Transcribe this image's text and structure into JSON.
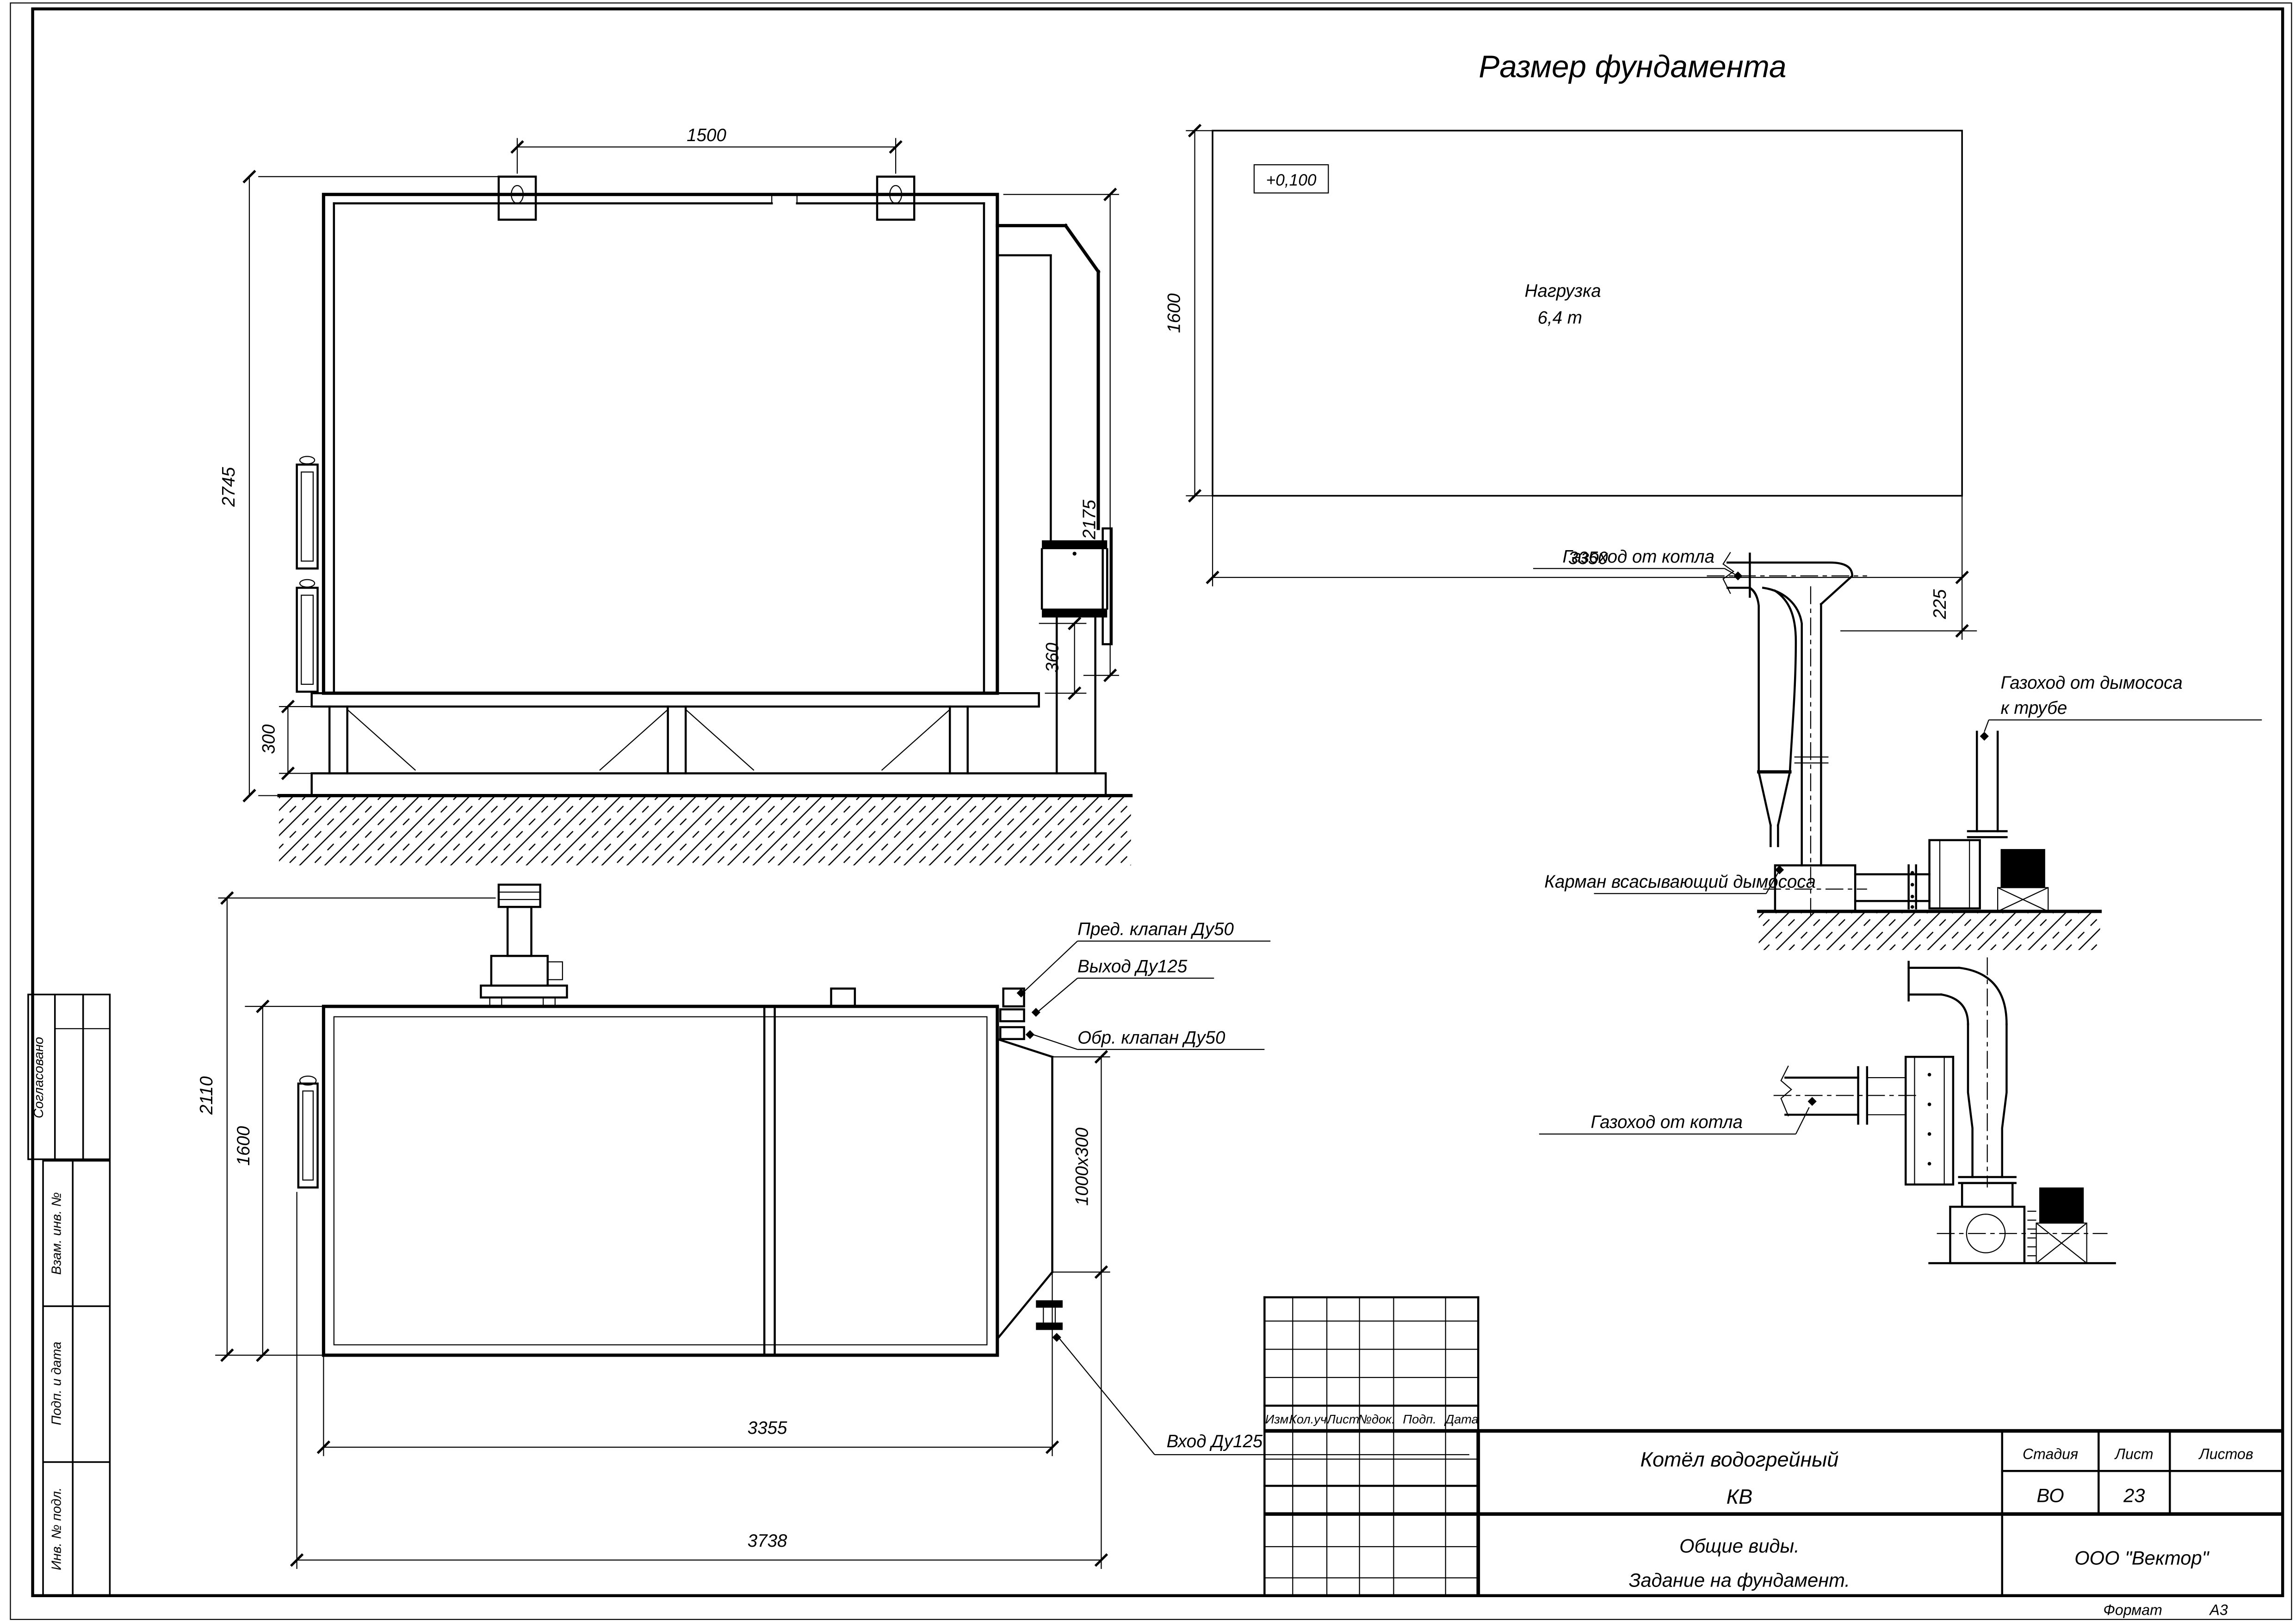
{
  "page": {
    "title": "Размер фундамента",
    "format_label": "Формат",
    "format_value": "А3"
  },
  "side_view": {
    "dim_1500": "1500",
    "dim_2745": "2745",
    "dim_2175": "2175",
    "dim_300": "300",
    "dim_360": "360"
  },
  "foundation_plan": {
    "elevation": "+0,100",
    "load_line1": "Нагрузка",
    "load_line2": "6,4 т",
    "dim_1600": "1600",
    "dim_3350": "3350",
    "dim_225": "225"
  },
  "top_view": {
    "dim_2110": "2110",
    "dim_1600": "1600",
    "dim_3355": "3355",
    "dim_3738": "3738",
    "dim_duct": "1000x300",
    "label_safety_valve": "Пред. клапан Ду50",
    "label_outlet": "Выход Ду125",
    "label_check_valve": "Обр. клапан Ду50",
    "label_inlet": "Вход Ду125"
  },
  "flue_upper": {
    "label_from_boiler": "Газоход от котла",
    "label_to_stack_line1": "Газоход от дымососа",
    "label_to_stack_line2": "к трубе",
    "label_pocket": "Карман всасывающий дымососа"
  },
  "flue_lower": {
    "label_from_boiler": "Газоход от котла"
  },
  "revision_table": {
    "col_izm": "Изм.",
    "col_koluch": "Кол.уч.",
    "col_list": "Лист",
    "col_ndok": "№док.",
    "col_podp": "Подп.",
    "col_data": "Дата"
  },
  "title_block": {
    "product_line1": "Котёл водогрейный",
    "product_line2": "КВ",
    "doc_line1": "Общие виды.",
    "doc_line2": "Задание на фундамент.",
    "stage_label": "Стадия",
    "sheet_label": "Лист",
    "sheets_label": "Листов",
    "stage_value": "ВО",
    "sheet_value": "23",
    "org": "ООО \"Вектор\""
  },
  "left_stamp": {
    "approved": "Согласовано",
    "vzam": "Взам. инв. №",
    "podp": "Подп. и дата",
    "inv": "Инв. № подл."
  }
}
